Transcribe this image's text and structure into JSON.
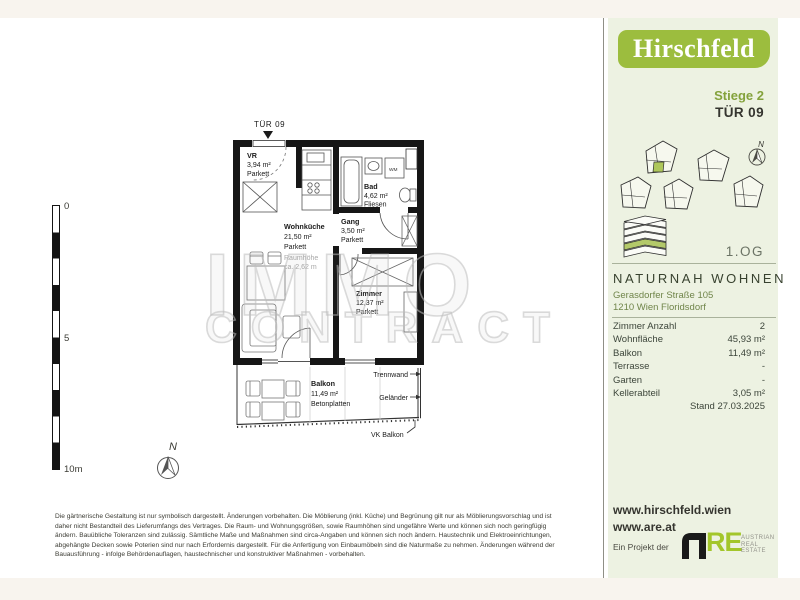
{
  "watermark": {
    "line1": "IMMO",
    "line2": "CONTRACT"
  },
  "scale_bar": {
    "top_label": "0",
    "mid_label": "5",
    "bottom_label": "10m"
  },
  "plan_compass_label": "N",
  "floor_plan": {
    "door_label": "TÜR 09",
    "rooms": {
      "vr": {
        "name": "VR",
        "area": "3,94 m²",
        "floor": "Parkett"
      },
      "wohnkueche": {
        "name": "Wohnküche",
        "area": "21,50 m²",
        "floor": "Parkett",
        "height_note_1": "Raumhöhe",
        "height_note_2": "ca. 2,62 m"
      },
      "bad": {
        "name": "Bad",
        "area": "4,62 m²",
        "floor": "Fliesen"
      },
      "gang": {
        "name": "Gang",
        "area": "3,50 m²",
        "floor": "Parkett"
      },
      "zimmer": {
        "name": "Zimmer",
        "area": "12,37 m²",
        "floor": "Parkett"
      },
      "balkon": {
        "name": "Balkon",
        "area": "11,49 m²",
        "floor": "Betonplatten"
      }
    },
    "appliance_label": "WM",
    "annotations": {
      "trennwand": "Trennwand",
      "gelaender": "Geländer",
      "vk_balkon": "VK Balkon"
    }
  },
  "sidebar": {
    "logo_text": "Hirschfeld",
    "staircase": "Stiege 2",
    "door": "TÜR 09",
    "compass_label": "N",
    "floor_label": "1.OG",
    "project_name": "NATURNAH WOHNEN",
    "address_line1": "Gerasdorfer Straße 105",
    "address_line2": "1210 Wien Floridsdorf",
    "details": {
      "rows": [
        {
          "label": "Zimmer Anzahl",
          "value": "2"
        },
        {
          "label": "Wohnfläche",
          "value": "45,93 m²"
        },
        {
          "label": "Balkon",
          "value": "11,49 m²"
        },
        {
          "label": "Terrasse",
          "value": "-"
        },
        {
          "label": "Garten",
          "value": "-"
        },
        {
          "label": "Kellerabteil",
          "value": "3,05 m²"
        }
      ]
    },
    "stand": "Stand 27.03.2025",
    "links": {
      "website1": "www.hirschfeld.wien",
      "website2": "www.are.at"
    },
    "project_by": "Ein Projekt der",
    "are_logo": {
      "re": "RE",
      "line1": "AUSTRIAN",
      "line2": "REAL",
      "line3": "ESTATE"
    }
  },
  "disclaimer": {
    "lines": [
      "Die gärtnerische Gestaltung ist nur symbolisch dargestellt. Änderungen vorbehalten. Die Möblierung (inkl. Küche) und Begrünung gilt nur als Möblierungsvorschlag und ist",
      "daher nicht Bestandteil des Lieferumfangs des Vertrages. Die Raum- und Wohnungsgrößen, sowie Raumhöhen sind ungefähre Werte und können sich noch geringfügig",
      "ändern. Bauübliche Toleranzen sind zulässig. Sämtliche Maße und Maßnahmen sind circa-Angaben und können sich noch ändern. Haustechnik und Elektroeinrichtungen,",
      "abgehängte Decken sowie Poterien sind nur nach Erfordernis dargestellt. Für die Anfertigung von Einbaumöbeln sind die Naturmaße zu nehmen. Änderungen während der",
      "Bauausführung - infolge Behördenauflagen, haustechnischer und konstruktiver Maßnahmen - vorbehalten."
    ]
  },
  "colors": {
    "accent_green": "#9cbd3e",
    "sidebar_bg": "#edf2e2",
    "unit_highlight": "#aec75a",
    "text_dark": "#35352f",
    "text_green": "#70854a"
  }
}
